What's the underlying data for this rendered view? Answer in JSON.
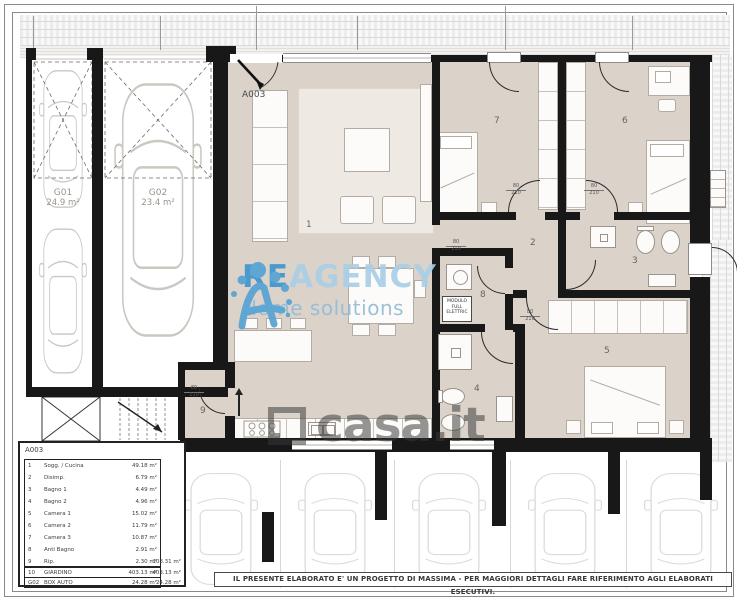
{
  "plan": {
    "entrance_label": "A003",
    "room_labels": [
      "1",
      "2",
      "3",
      "4",
      "5",
      "6",
      "7",
      "8",
      "9"
    ],
    "garages": [
      {
        "code": "G01",
        "area": "24.9 m²"
      },
      {
        "code": "G02",
        "area": "23.4 m²"
      }
    ],
    "module_box": {
      "line1": "MODULO",
      "line2": "FULL",
      "line3": "ELETTRIC"
    },
    "door_size": {
      "width": "80",
      "height": "210"
    }
  },
  "legend": {
    "title": "A003",
    "rows": [
      {
        "id": "1",
        "name": "Sogg. / Cucina",
        "area": "49.18 m²",
        "subtotal": ""
      },
      {
        "id": "2",
        "name": "Disimp.",
        "area": "6.79 m²",
        "subtotal": ""
      },
      {
        "id": "3",
        "name": "Bagno 1",
        "area": "4.49 m²",
        "subtotal": ""
      },
      {
        "id": "4",
        "name": "Bagno 2",
        "area": "4.96 m²",
        "subtotal": ""
      },
      {
        "id": "5",
        "name": "Camera 1",
        "area": "15.02 m²",
        "subtotal": ""
      },
      {
        "id": "6",
        "name": "Camera 2",
        "area": "11.79 m²",
        "subtotal": ""
      },
      {
        "id": "7",
        "name": "Camera 3",
        "area": "10.87 m²",
        "subtotal": ""
      },
      {
        "id": "8",
        "name": "Anti Bagno",
        "area": "2.91 m²",
        "subtotal": ""
      },
      {
        "id": "9",
        "name": "Rip.",
        "area": "2.30 m²",
        "subtotal": "108.31 m²"
      },
      {
        "id": "10",
        "name": "GIARDINO",
        "area": "403.13 m²",
        "subtotal": "403.13 m²"
      },
      {
        "id": "G02",
        "name": "BOX AUTO",
        "area": "24.28 m²",
        "subtotal": "24.28 m²"
      }
    ]
  },
  "watermarks": {
    "agency": {
      "brand_bold": "RE",
      "brand_light": "AGENCY",
      "tagline": "Home solutions"
    },
    "portal": {
      "text": "casa.it"
    }
  },
  "footer": {
    "disclaimer": "IL PRESENTE ELABORATO E' UN PROGETTO DI MASSIMA - PER MAGGIORI DETTAGLI FARE RIFERIMENTO AGLI ELABORATI ESECUTIVI."
  }
}
